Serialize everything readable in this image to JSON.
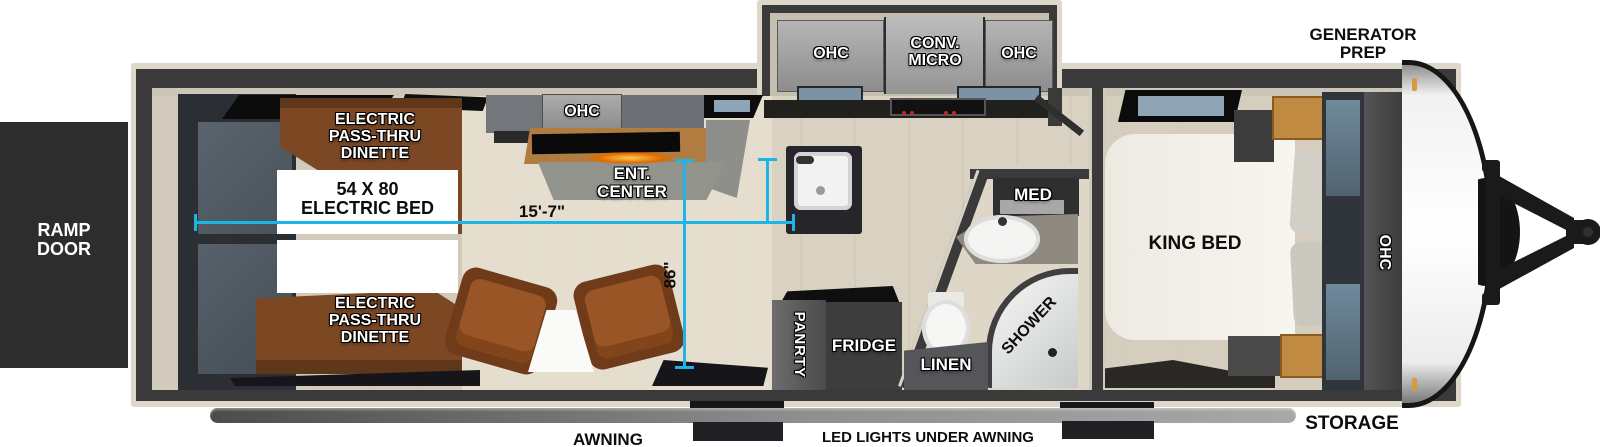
{
  "colors": {
    "accent": "#1db5e8",
    "wall": "#3a3a3a",
    "trim": "#dcd7c9",
    "ramp": "#2d2d2d",
    "wood": "#7c4824"
  },
  "exterior": {
    "ramp_door": "RAMP DOOR",
    "generator_prep": "GENERATOR PREP",
    "storage": "STORAGE",
    "awning": "AWNING",
    "led_lights": "LED LIGHTS UNDER AWNING"
  },
  "garage": {
    "dinette_top": [
      "ELECTRIC",
      "PASS-THRU",
      "DINETTE"
    ],
    "dinette_bottom": [
      "ELECTRIC",
      "PASS-THRU",
      "DINETTE"
    ],
    "bed_box": [
      "54 X 80",
      "ELECTRIC BED"
    ],
    "ohc": "OHC",
    "ent_center": [
      "ENT.",
      "CENTER"
    ]
  },
  "kitchen": {
    "ohc_left": "OHC",
    "conv_micro": [
      "CONV.",
      "MICRO"
    ],
    "ohc_right": "OHC"
  },
  "utility": {
    "pantry": "PANRTY",
    "fridge": "FRIDGE"
  },
  "bathroom": {
    "med": "MED",
    "shower": "SHOWER",
    "linen": "LINEN"
  },
  "bedroom": {
    "king_bed": "KING BED",
    "ohc": "OHC"
  },
  "dimensions": {
    "length": "15'-7\"",
    "height": "86\""
  }
}
